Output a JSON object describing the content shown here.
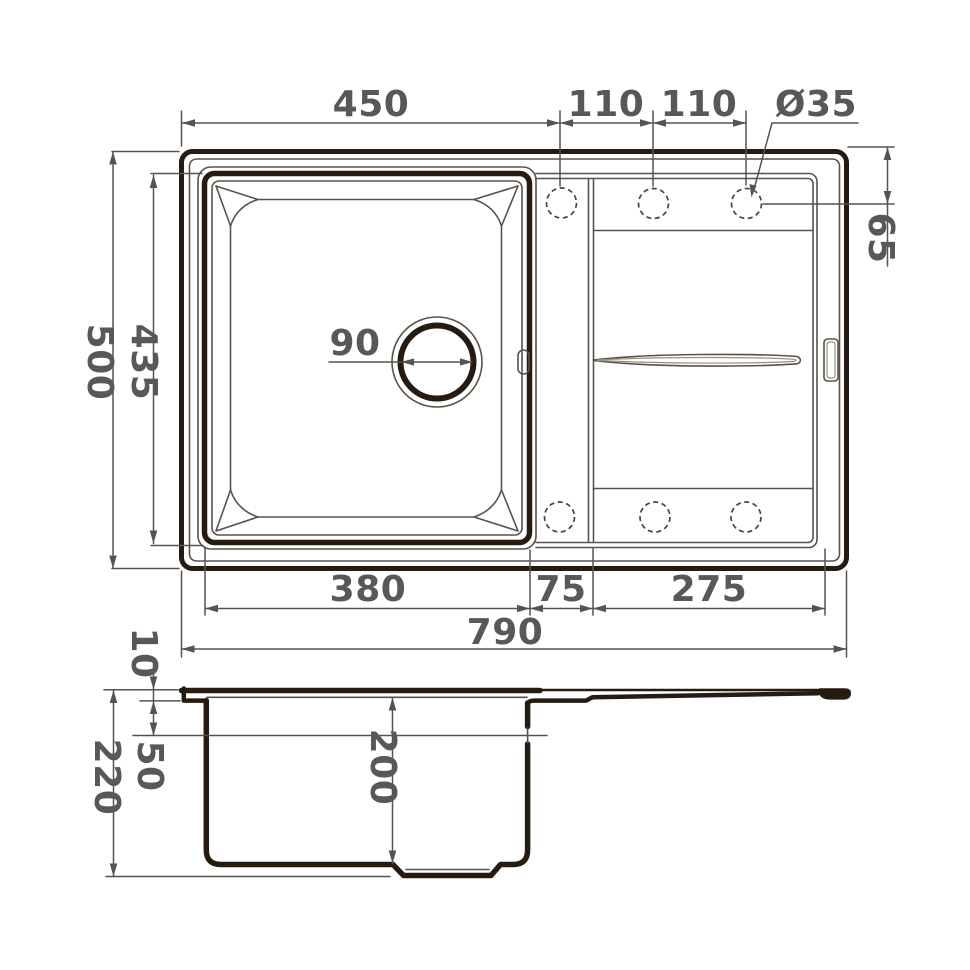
{
  "drawing": {
    "type": "sink technical drawing, top view and section view",
    "colors": {
      "background": "#ffffff",
      "outline_dark": "#261b11",
      "thin_line": "#5a524a",
      "dimension_line": "#57534f",
      "label_text": "#58585a"
    },
    "top_view": {
      "dims": {
        "bowl_outer_width": "450",
        "hole_spacing_1": "110",
        "hole_spacing_2": "110",
        "tap_hole_diameter": "Ø35",
        "overall_depth": "500",
        "bowl_depth": "435",
        "drain_diameter": "90",
        "hole_edge_offset": "65",
        "bowl_inner_width": "380",
        "divider_width": "75",
        "drainboard_width": "275",
        "overall_width": "790"
      }
    },
    "side_view": {
      "dims": {
        "rim_thickness": "10",
        "overflow_level": "50",
        "overall_height": "220",
        "bowl_inner_depth": "200"
      }
    }
  }
}
